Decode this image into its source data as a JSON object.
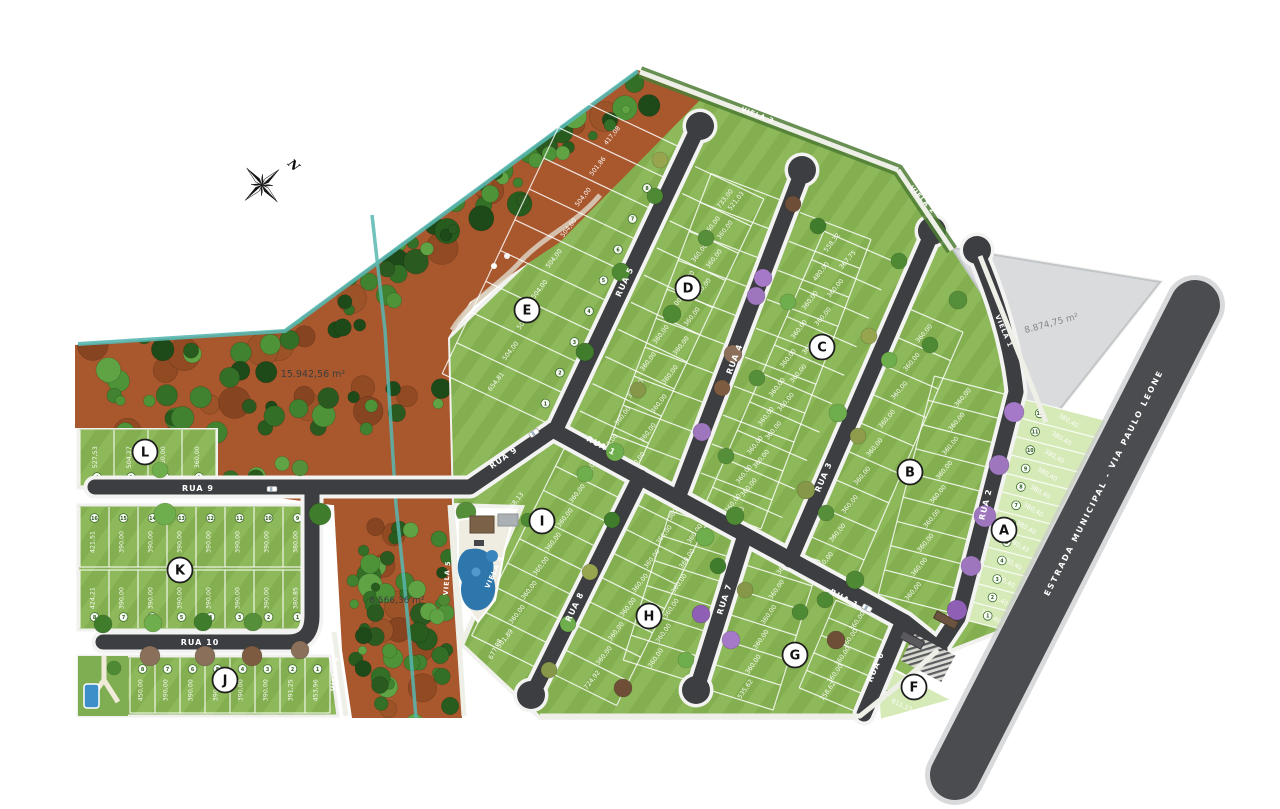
{
  "compass": {
    "label": "N"
  },
  "colors": {
    "road": "#3c3e41",
    "curb": "#f3f3f1",
    "lawn_a": "#83af50",
    "lawn_b": "#8db95a",
    "lot_light": "#d6eab8",
    "soil": "#a9582e",
    "water": "#57b7b0",
    "gray_area": "#d9dbdd",
    "purple_tree": "#9d76bd",
    "line_white": "#ffffff"
  },
  "area_labels": [
    {
      "id": "preservation-area",
      "text": "15.942,56 m²",
      "x": 313,
      "y": 377,
      "rot": 0,
      "size": 9.5,
      "color": "#3c3c3c"
    },
    {
      "id": "buffer-area",
      "text": "6.566,36 m²",
      "x": 397,
      "y": 603,
      "rot": 0,
      "size": 9,
      "color": "#3c3c3c"
    },
    {
      "id": "institutional-area",
      "text": "8.874,75 m²",
      "x": 1052,
      "y": 326,
      "rot": -15,
      "size": 9,
      "color": "#85888b"
    }
  ],
  "blocks": [
    {
      "letter": "A",
      "x": 1004,
      "y": 530
    },
    {
      "letter": "B",
      "x": 910,
      "y": 472
    },
    {
      "letter": "C",
      "x": 822,
      "y": 347
    },
    {
      "letter": "D",
      "x": 688,
      "y": 288
    },
    {
      "letter": "E",
      "x": 527,
      "y": 310
    },
    {
      "letter": "F",
      "x": 914,
      "y": 687
    },
    {
      "letter": "G",
      "x": 795,
      "y": 655
    },
    {
      "letter": "H",
      "x": 649,
      "y": 616
    },
    {
      "letter": "I",
      "x": 542,
      "y": 521
    },
    {
      "letter": "J",
      "x": 225,
      "y": 680
    },
    {
      "letter": "K",
      "x": 180,
      "y": 570
    },
    {
      "letter": "L",
      "x": 145,
      "y": 452
    }
  ],
  "street_labels": [
    {
      "text": "RUA 9",
      "x": 198,
      "y": 491,
      "rot": 0,
      "s": 8
    },
    {
      "text": "RUA 9",
      "x": 505,
      "y": 460,
      "rot": -35,
      "s": 8
    },
    {
      "text": "RUA 10",
      "x": 200,
      "y": 645,
      "rot": 0,
      "s": 8
    },
    {
      "text": "RUA 1",
      "x": 600,
      "y": 448,
      "rot": 28,
      "s": 8
    },
    {
      "text": "RUA 1",
      "x": 843,
      "y": 601,
      "rot": 28,
      "s": 8
    },
    {
      "text": "RUA 5",
      "x": 627,
      "y": 283,
      "rot": -65,
      "s": 8
    },
    {
      "text": "RUA 4",
      "x": 737,
      "y": 360,
      "rot": -69,
      "s": 8
    },
    {
      "text": "RUA 3",
      "x": 826,
      "y": 478,
      "rot": -67,
      "s": 8
    },
    {
      "text": "RUA 2",
      "x": 988,
      "y": 505,
      "rot": -76,
      "s": 8
    },
    {
      "text": "RUA 8",
      "x": 577,
      "y": 608,
      "rot": -64,
      "s": 8
    },
    {
      "text": "RUA 7",
      "x": 727,
      "y": 600,
      "rot": -72,
      "s": 8
    },
    {
      "text": "RUA 6",
      "x": 878,
      "y": 668,
      "rot": -67,
      "s": 8
    },
    {
      "text": "VIELA 3",
      "x": 757,
      "y": 117,
      "rot": 21,
      "s": 6.5
    },
    {
      "text": "VIELA 2",
      "x": 921,
      "y": 201,
      "rot": 48,
      "s": 6.5
    },
    {
      "text": "VIELA 1",
      "x": 1002,
      "y": 332,
      "rot": 67,
      "s": 6.5
    },
    {
      "text": "VIELA 4",
      "x": 496,
      "y": 573,
      "rot": -66,
      "s": 6.5
    },
    {
      "text": "VIELA 5",
      "x": 449,
      "y": 578,
      "rot": -86,
      "s": 6.5
    },
    {
      "text": "VIELA 6",
      "x": 337,
      "y": 674,
      "rot": -84,
      "s": 6.5
    },
    {
      "text": "ESTRADA MUNICIPAL - VIA PAULO LEONE",
      "x": 1106,
      "y": 484,
      "rot": -63,
      "s": 8,
      "ls": 2
    }
  ],
  "lots": {
    "A": {
      "values": [
        "380,40",
        "380,40",
        "380,40",
        "380,40",
        "380,40",
        "380,40",
        "380,40",
        "380,40",
        "380,40",
        "380,40",
        "380,40",
        "380,40"
      ],
      "numbers": [
        "1",
        "2",
        "3",
        "4",
        "5",
        "6",
        "7",
        "8",
        "9",
        "10",
        "11",
        "12"
      ]
    },
    "E": {
      "values": [
        "654,81",
        "504,00",
        "504,00",
        "504,00",
        "504,00",
        "504,00",
        "504,00",
        "501,86",
        "417,08"
      ],
      "numbers": [
        "1",
        "2",
        "3",
        "4",
        "5",
        "6",
        "7",
        "8",
        "9"
      ]
    },
    "L": {
      "values": [
        "527,53",
        "504,27",
        "360,00",
        "360,00"
      ],
      "numbers": [
        "4",
        "3",
        "2",
        "1"
      ]
    },
    "K_top": {
      "values": [
        "421,51",
        "390,00",
        "390,00",
        "390,00",
        "390,00",
        "390,00",
        "390,00",
        "380,00"
      ],
      "numbers": [
        "16",
        "15",
        "14",
        "13",
        "12",
        "11",
        "10",
        "9"
      ]
    },
    "K_bottom": {
      "values": [
        "424,21",
        "390,00",
        "390,00",
        "390,00",
        "390,00",
        "390,00",
        "390,00",
        "380,85"
      ],
      "numbers": [
        "8",
        "7",
        "6",
        "5",
        "4",
        "3",
        "2",
        "1"
      ]
    },
    "J": {
      "values": [
        "450,00",
        "390,00",
        "390,00",
        "390,00",
        "390,00",
        "390,00",
        "391,25",
        "453,96"
      ],
      "numbers": [
        "8",
        "7",
        "6",
        "5",
        "4",
        "3",
        "2",
        "1"
      ]
    },
    "D_left": {
      "values": [
        "360,00",
        "360,00",
        "360,00",
        "360,00",
        "360,00",
        "360,00",
        "360,00",
        "360,00",
        "360,00",
        "733,00"
      ]
    },
    "D_right": {
      "values": [
        "360,00",
        "360,00",
        "360,00",
        "360,00",
        "360,00",
        "360,00",
        "360,00",
        "360,00",
        "360,00",
        "521,03"
      ]
    },
    "C_left": {
      "values": [
        "360,00",
        "360,00",
        "360,00",
        "360,00",
        "360,00",
        "360,00",
        "360,00",
        "360,00",
        "480,00",
        "558,32"
      ]
    },
    "C_right": {
      "values": [
        "360,00",
        "360,00",
        "360,00",
        "360,00",
        "360,00",
        "360,00",
        "360,00",
        "360,00",
        "360,00",
        "367,75"
      ]
    },
    "B_left": {
      "values": [
        "360,00",
        "360,00",
        "360,00",
        "360,00",
        "360,00",
        "360,00",
        "360,00",
        "360,00",
        "360,00"
      ]
    },
    "B_right": {
      "values": [
        "360,00",
        "360,00",
        "360,00",
        "360,00",
        "360,00",
        "360,00",
        "360,00",
        "360,00",
        "360,00"
      ]
    },
    "I_right": {
      "values": [
        "360,00",
        "360,00",
        "360,00",
        "360,00",
        "360,00",
        "360,00",
        "360,00",
        "501,89"
      ]
    },
    "H_left": {
      "values": [
        "360,00",
        "360,00",
        "360,00",
        "360,00",
        "360,00",
        "360,00",
        "360,00",
        "724,92"
      ]
    },
    "H_right": {
      "values": [
        "360,00",
        "360,00",
        "360,00",
        "360,00",
        "360,00",
        "360,00"
      ]
    },
    "G_left": {
      "values": [
        "360,00",
        "360,00",
        "360,00",
        "360,00",
        "360,00",
        "535,62"
      ]
    },
    "G_right": {
      "values": [
        "360,00",
        "360,00",
        "360,00",
        "360,00",
        "758,62"
      ]
    }
  },
  "extra_lots": [
    {
      "text": "368,13",
      "x": 517,
      "y": 503,
      "rot": -52
    },
    {
      "text": "677,08",
      "x": 497,
      "y": 650,
      "rot": -62
    },
    {
      "text": "611,13",
      "x": 901,
      "y": 707,
      "rot": 25
    }
  ],
  "f_lot_number": "2"
}
